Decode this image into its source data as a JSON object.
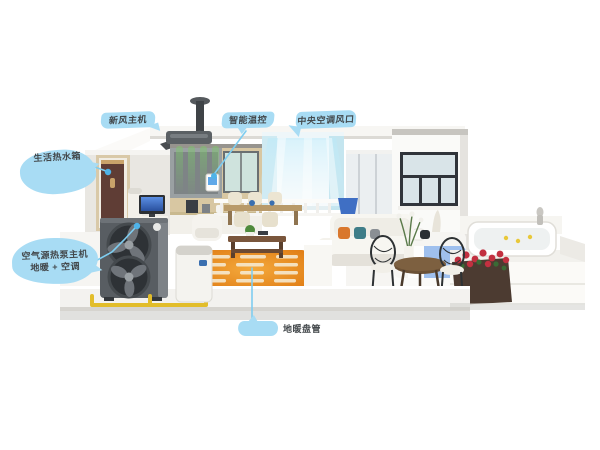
{
  "callouts": {
    "fresh_air_unit": {
      "label": "新风主机"
    },
    "thermostat": {
      "label": "智能温控"
    },
    "central_ac": {
      "label": "中央空调风口"
    },
    "hot_water": {
      "label": "生活热水箱"
    },
    "heat_pump": {
      "label_line1": "空气源热泵主机",
      "label_line2": "地暖 + 空调"
    },
    "floor_heating": {
      "label": "地暖盘管"
    }
  },
  "colors": {
    "balloon_blue": "#a8dcf4",
    "leader_blue": "#7ecdf0",
    "dot_blue": "#4fb3e8",
    "label_text": "#43484b",
    "rug_orange": "#e08020",
    "fresh_air_green": "#7cc86a",
    "ac_air_blue": "#9fdef5",
    "pipe_yellow": "#e2bd2a",
    "heat_pump_body": "#585d62"
  }
}
